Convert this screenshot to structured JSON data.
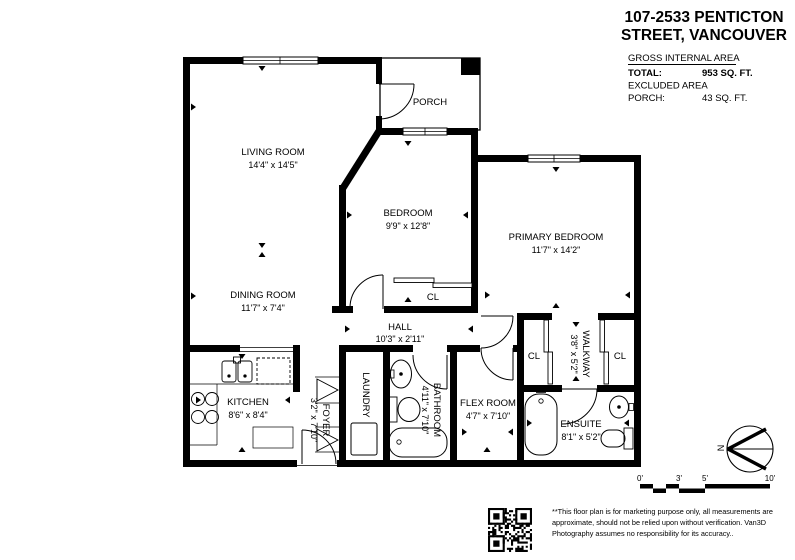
{
  "header": {
    "title_line1": "107-2533 PENTICTON",
    "title_line2": "STREET, VANCOUVER"
  },
  "area_summary": {
    "heading": "GROSS INTERNAL AREA",
    "total_label": "TOTAL:",
    "total_value": "953 SQ. FT.",
    "excluded_label": "EXCLUDED AREA",
    "porch_label": "PORCH:",
    "porch_value": "43 SQ. FT."
  },
  "rooms": {
    "living": {
      "name": "LIVING ROOM",
      "dims": "14'4\" x 14'5\""
    },
    "dining": {
      "name": "DINING ROOM",
      "dims": "11'7\" x 7'4\""
    },
    "porch": {
      "name": "PORCH"
    },
    "bedroom": {
      "name": "BEDROOM",
      "dims": "9'9\" x 12'8\""
    },
    "primary": {
      "name": "PRIMARY BEDROOM",
      "dims": "11'7\" x 14'2\""
    },
    "hall": {
      "name": "HALL",
      "dims": "10'3\" x 2'11\""
    },
    "kitchen": {
      "name": "KITCHEN",
      "dims": "8'6\" x 8'4\""
    },
    "foyer": {
      "name": "FOYER",
      "dims": "3'2\" x 7'10\""
    },
    "laundry": {
      "name": "LAUNDRY"
    },
    "bathroom": {
      "name": "BATHROOM",
      "dims": "4'11\" x 7'10\""
    },
    "flex": {
      "name": "FLEX ROOM",
      "dims": "4'7\" x 7'10\""
    },
    "ensuite": {
      "name": "ENSUITE",
      "dims": "8'1\" x 5'2\""
    },
    "walkway": {
      "name": "WALKWAY",
      "dims": "3'8\" x 5'2\""
    },
    "closet": {
      "name": "CL"
    }
  },
  "compass": {
    "north": "N"
  },
  "scale_bar": {
    "labels": [
      "0'",
      "3'",
      "5'",
      "10'"
    ]
  },
  "footer": {
    "disclaimer_line1": "**This floor plan is for marketing purpose only, all measurements are",
    "disclaimer_line2": "approximate, should not be relied upon without verification. Van3D",
    "disclaimer_line3": "Photography assumes no responsibility for its accuracy.."
  },
  "colors": {
    "wall": "#000000",
    "background": "#ffffff"
  }
}
